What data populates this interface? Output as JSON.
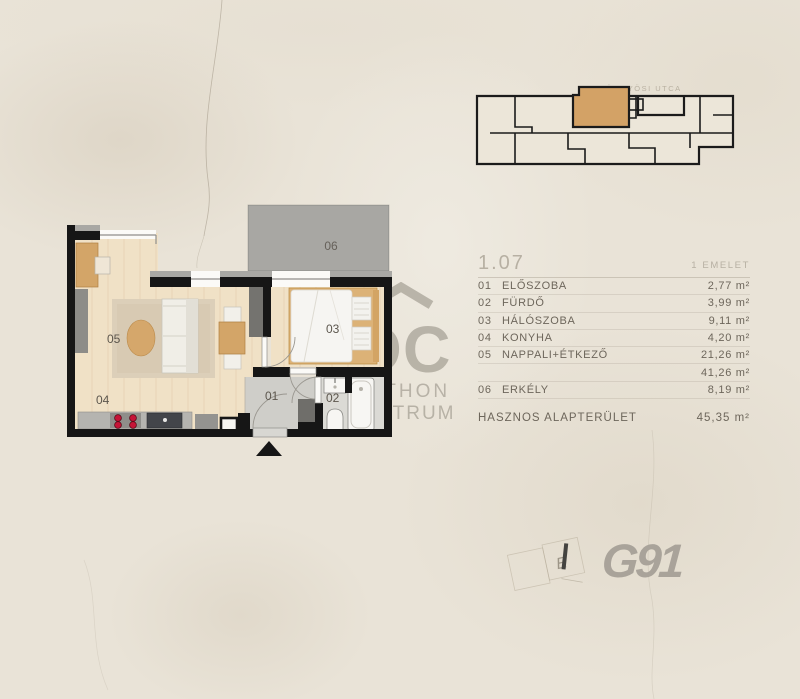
{
  "site_plan": {
    "street_label": "GYÖNGYÖSI UTCA"
  },
  "legend": {
    "unit_number": "1.07",
    "floor_label": "1 EMELET",
    "rooms": [
      {
        "num": "01",
        "name": "ELŐSZOBA",
        "area": "2,77 m²"
      },
      {
        "num": "02",
        "name": "FÜRDŐ",
        "area": "3,99 m²"
      },
      {
        "num": "03",
        "name": "HÁLÓSZOBA",
        "area": "9,11 m²"
      },
      {
        "num": "04",
        "name": "KONYHA",
        "area": "4,20 m²"
      },
      {
        "num": "05",
        "name": "NAPPALI+ÉTKEZŐ",
        "area": "21,26 m²"
      }
    ],
    "subtotal_area": "41,26 m²",
    "balcony": {
      "num": "06",
      "name": "ERKÉLY",
      "area": "8,19 m²"
    },
    "total_label": "HASZNOS ALAPTERÜLET",
    "total_area": "45,35 m²"
  },
  "floor_plan": {
    "room_labels": {
      "r01": "01",
      "r02": "02",
      "r03": "03",
      "r04": "04",
      "r05": "05",
      "r06": "06"
    }
  },
  "watermark": {
    "logo_text": "OC",
    "line1": "OTTHON",
    "line2": "CENTRUM"
  },
  "branding": {
    "g91": "G91",
    "stamp_letter": "E"
  },
  "colors": {
    "background": "#e9e3d7",
    "wall": "#161616",
    "wood_floor": "#f0e1c6",
    "balcony_gray": "#a8a7a3",
    "highlight_unit": "#d3a266",
    "legend_text": "#6d665b",
    "muted_text": "#b7b0a3",
    "burner_red": "#c61437"
  }
}
